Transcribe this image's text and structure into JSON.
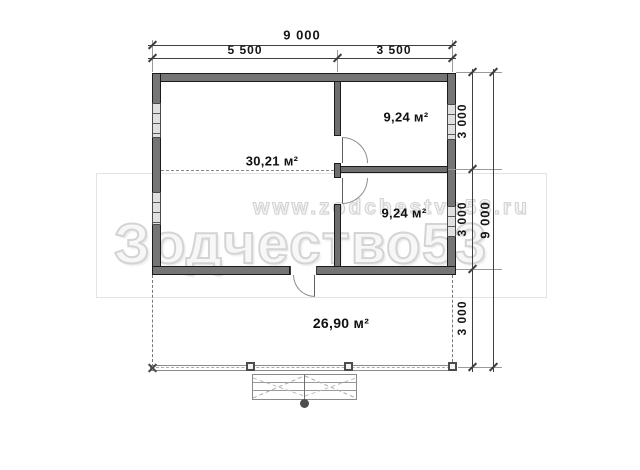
{
  "rooms": [
    {
      "id": "main-room",
      "area_label": "30,21 м²"
    },
    {
      "id": "top-right-room",
      "area_label": "9,24 м²"
    },
    {
      "id": "bottom-right-room",
      "area_label": "9,24 м²"
    },
    {
      "id": "terrace",
      "area_label": "26,90 м²"
    }
  ],
  "dimensions": {
    "top": {
      "total": "9 000",
      "segments": [
        "5 500",
        "3 500"
      ]
    },
    "right": {
      "total": "9 000",
      "segments": [
        "3 000",
        "3 000",
        "3 000"
      ]
    }
  },
  "watermark": {
    "url_line": "www.zodchestvo53.ru",
    "brand_line": "Зодчество53"
  },
  "colors": {
    "wall_fill": "#757575",
    "wall_outline": "#1b1b1b",
    "dimension_line": "#3f3f3f",
    "watermark_outline": "#d4d4d4",
    "background": "#ffffff"
  }
}
